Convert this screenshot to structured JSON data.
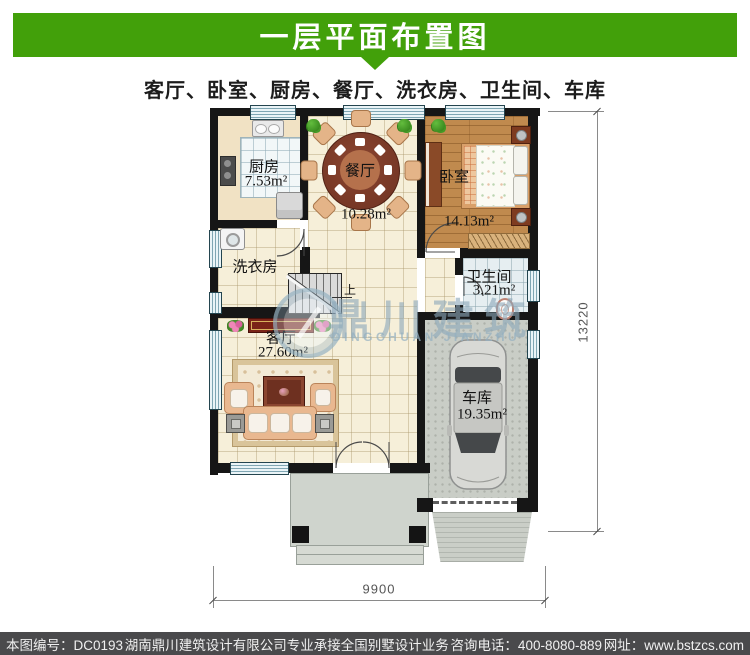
{
  "banner": {
    "title": "一层平面布置图"
  },
  "subtitle": "客厅、卧室、厨房、餐厅、洗衣房、卫生间、车库",
  "plan": {
    "rooms": {
      "kitchen": {
        "name": "厨房",
        "area": "7.53m²"
      },
      "dining": {
        "name": "餐厅",
        "area": "10.28m²"
      },
      "bedroom": {
        "name": "卧室",
        "area": "14.13m²"
      },
      "laundry": {
        "name": "洗衣房"
      },
      "bathroom": {
        "name": "卫生间",
        "area": "3.21m²"
      },
      "living": {
        "name": "客厅",
        "area": "27.60m²"
      },
      "garage": {
        "name": "车库",
        "area": "19.35m²"
      }
    },
    "stairs_up_label": "上",
    "dimensions": {
      "bottom": "9900",
      "right": "13220"
    }
  },
  "watermark": {
    "cn": "鼎川建筑",
    "en": "DINGCHUAN JIANZHU"
  },
  "footer": {
    "drawing_no": "本图编号：DC0193",
    "company": "湖南鼎川建筑设计有限公司专业承接全国别墅设计业务",
    "phone": "咨询电话：400-8080-889",
    "website": "网址：www.bstzcs.com"
  },
  "colors": {
    "banner_green": "#42a00a",
    "footer_gray": "#4a4a4c",
    "wall": "#161616"
  }
}
